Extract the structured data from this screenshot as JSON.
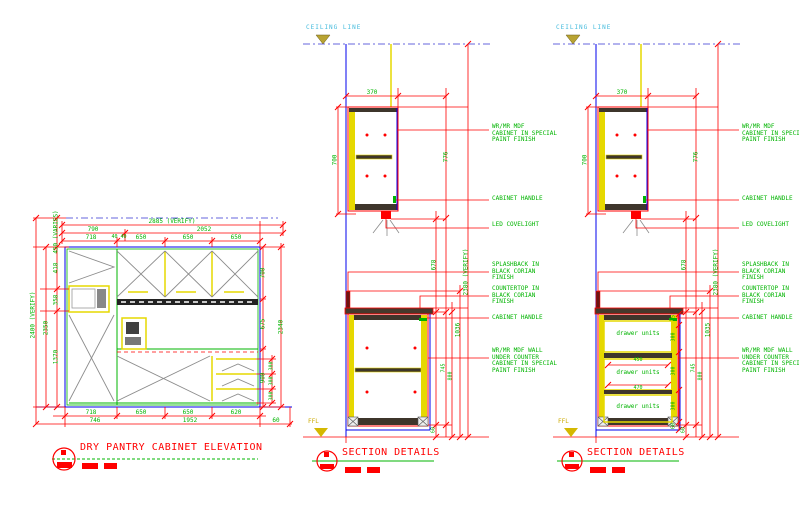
{
  "drawing": {
    "background": "#FFFFFF",
    "colors": {
      "dimension": "#FF0000",
      "annotation_text": "#00B400",
      "structure_blue": "#0000EE",
      "panel_yellow": "#E6D800",
      "ceiling_text": "#44BBDD",
      "ffl_text": "#CCAA00"
    }
  },
  "elevation": {
    "title": "DRY PANTRY CABINET ELEVATION",
    "dims_top": {
      "total": "2885 (VERIFY)",
      "seg_left": "790",
      "seg_right": "2052",
      "row3": [
        "718",
        "40 40",
        "650",
        "650",
        "650"
      ]
    },
    "dims_left": {
      "overall": "2400 (VERIFY)",
      "inner": "2350",
      "chain": [
        "450 (VARIES)",
        "418",
        "358",
        "1370"
      ]
    },
    "dims_right": {
      "chain": [
        "700",
        "675",
        "900"
      ],
      "outer": "2340",
      "drawer_dims": [
        "300",
        "300",
        "300"
      ]
    },
    "dims_bottom": {
      "row1": [
        "718",
        "650",
        "650",
        "620"
      ],
      "row2": [
        "746",
        "1952",
        "60"
      ]
    }
  },
  "section_mid": {
    "title": "SECTION DETAILS",
    "ceiling_label": "CEILING LINE",
    "ffl_label": "FFL",
    "depth_dim": "370",
    "left_dim": "700",
    "right_dims": [
      "776",
      "678",
      "2380 (VERIFY)",
      "1036",
      "745",
      "800",
      "60"
    ],
    "annotations": [
      "WR/MR MDF\nCABINET IN SPECIAL\nPAINT FINISH",
      "CABINET HANDLE",
      "LED COVELIGHT",
      "SPLASHBACK IN\nBLACK CORIAN\nFINISH",
      "COUNTERTOP IN\nBLACK CORIAN\nFINISH",
      "CABINET HANDLE",
      "WR/MR MDF WALL\nUNDER COUNTER\nCABINET IN SPECIAL\nPAINT FINISH"
    ]
  },
  "section_right": {
    "title": "SECTION DETAILS",
    "ceiling_label": "CEILING LINE",
    "ffl_label": "FFL",
    "depth_dim": "370",
    "left_dim": "700",
    "right_dims": [
      "776",
      "678",
      "2380 (VERIFY)",
      "1035",
      "745",
      "800",
      "60"
    ],
    "drawer_labels": [
      "drawer units",
      "drawer units",
      "drawer units"
    ],
    "drawer_width_dims": [
      "450",
      "470"
    ],
    "drawer_chain": [
      "75",
      "300",
      "300",
      "300",
      "60"
    ],
    "annotations": [
      "WR/MR MDF\nCABINET IN SPECIAL\nPAINT FINISH",
      "CABINET HANDLE",
      "LED COVELIGHT",
      "SPLASHBACK IN\nBLACK CORIAN\nFINISH",
      "COUNTERTOP IN\nBLACK CORIAN\nFINISH",
      "CABINET HANDLE",
      "WR/MR MDF WALL\nUNDER COUNTER\nCABINET IN SPECIAL\nPAINT FINISH"
    ]
  }
}
